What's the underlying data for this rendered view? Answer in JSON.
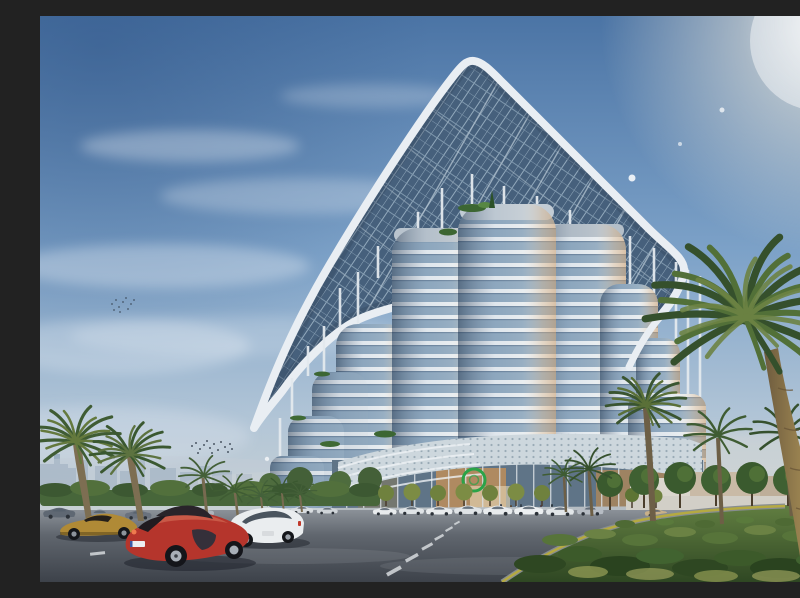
{
  "meta": {
    "type": "architectural-rendering",
    "description": "Photorealistic rendering of a futuristic high-rise tower made of stacked elliptical glass volumes beneath a vast rounded-triangular photovoltaic canopy held on slender masts, viewed from street level in late-afternoon light with palm trees, a landscaped garden, a curving road, rows of parked sedans and three luxury cars in the foreground, a hazy city skyline on the left horizon and a sun flare in the upper right sky."
  },
  "palette": {
    "sky_top": "#4b74a5",
    "sky_mid": "#7da2c8",
    "sky_horizon": "#d8d9d2",
    "canopy_lattice": "#46607c",
    "canopy_rim": "#e9eef3",
    "tower_glass": "#8fa9c0",
    "tower_floor_band": "#e7edf2",
    "warm_reflection": "#cd9c68",
    "podium_mesh": "#cdd7dd",
    "entrance_glow": "#c39058",
    "logo_green": "#2ba348",
    "road_surface": "#4e545c",
    "lane_marking": "#d6dadd",
    "curb_yellow": "#b5aa42",
    "garden_green": "#4e6a34",
    "palm_frond": "#3d5a31",
    "palm_trunk": "#97804f",
    "skyline_haze": "#8fa4b8",
    "red_car": "#b5352c",
    "gold_car": "#b08a36",
    "white_car": "#eaedef"
  },
  "objects": {
    "building": "high-rise of stacked rounded glass volumes under a photovoltaic shell canopy with support masts, perforated podium and glowing glass lobby with green ring logo",
    "vehicles_foreground": [
      "red sports car",
      "gold coupe",
      "white luxury sedan"
    ],
    "vehicles_background": "rows of parked white, silver and dark sedans along both streets",
    "vegetation": [
      "date palms left and right",
      "clipped street trees at the lobby",
      "shrub ground-cover garden lower right",
      "hedge row on left horizon"
    ],
    "environment": [
      "hazy city skyline left",
      "two flocks of birds",
      "sun flare top right",
      "wispy clouds"
    ]
  }
}
